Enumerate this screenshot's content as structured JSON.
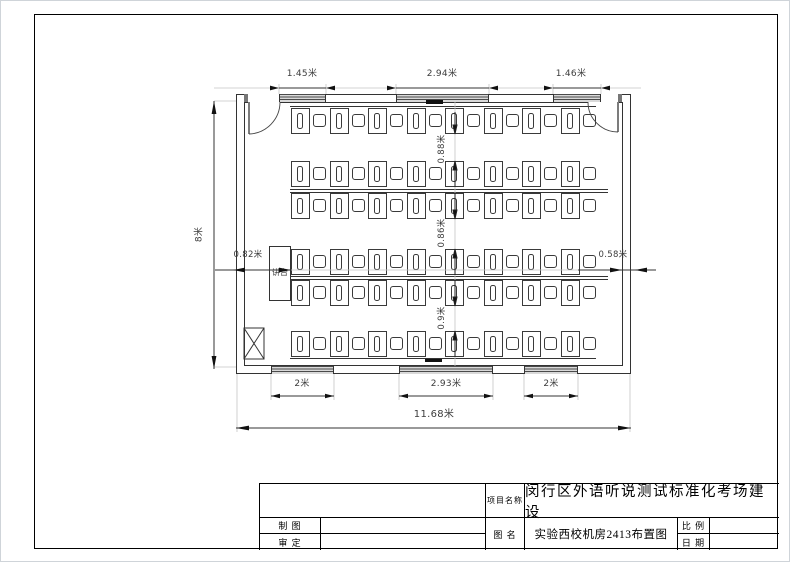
{
  "floorplan": {
    "dim_top": [
      "1.45米",
      "2.94米",
      "1.46米"
    ],
    "dim_left_height": "8米",
    "dim_podium_gap": "0.82米",
    "dim_right_gap": "0.58米",
    "dim_row_gaps": [
      "0.88米",
      "0.86米",
      "0.9米"
    ],
    "dim_bottom": [
      "2米",
      "2.93米",
      "2米"
    ],
    "dim_total_width": "11.68米",
    "podium_label": "讲台",
    "rows": [
      {
        "desks": 8
      },
      {
        "desks": 8
      },
      {
        "desks": 8
      },
      {
        "desks": 8
      },
      {
        "desks": 8
      },
      {
        "desks": 8
      }
    ]
  },
  "title_block": {
    "project_label": "项目名称",
    "project_name": "闵行区外语听说测试标准化考场建设",
    "draft_label": "制 图",
    "draft_value": "",
    "review_label": "审 定",
    "review_value": "",
    "drawing_label": "图 名",
    "drawing_name": "实验西校机房2413布置图",
    "scale_label": "比 例",
    "scale_value": "",
    "date_label": "日 期",
    "date_value": ""
  },
  "colors": {
    "line": "#333333",
    "light_line": "#c4c4c4",
    "window_hatch": "#4a4a4a",
    "arrow": "#111111"
  }
}
